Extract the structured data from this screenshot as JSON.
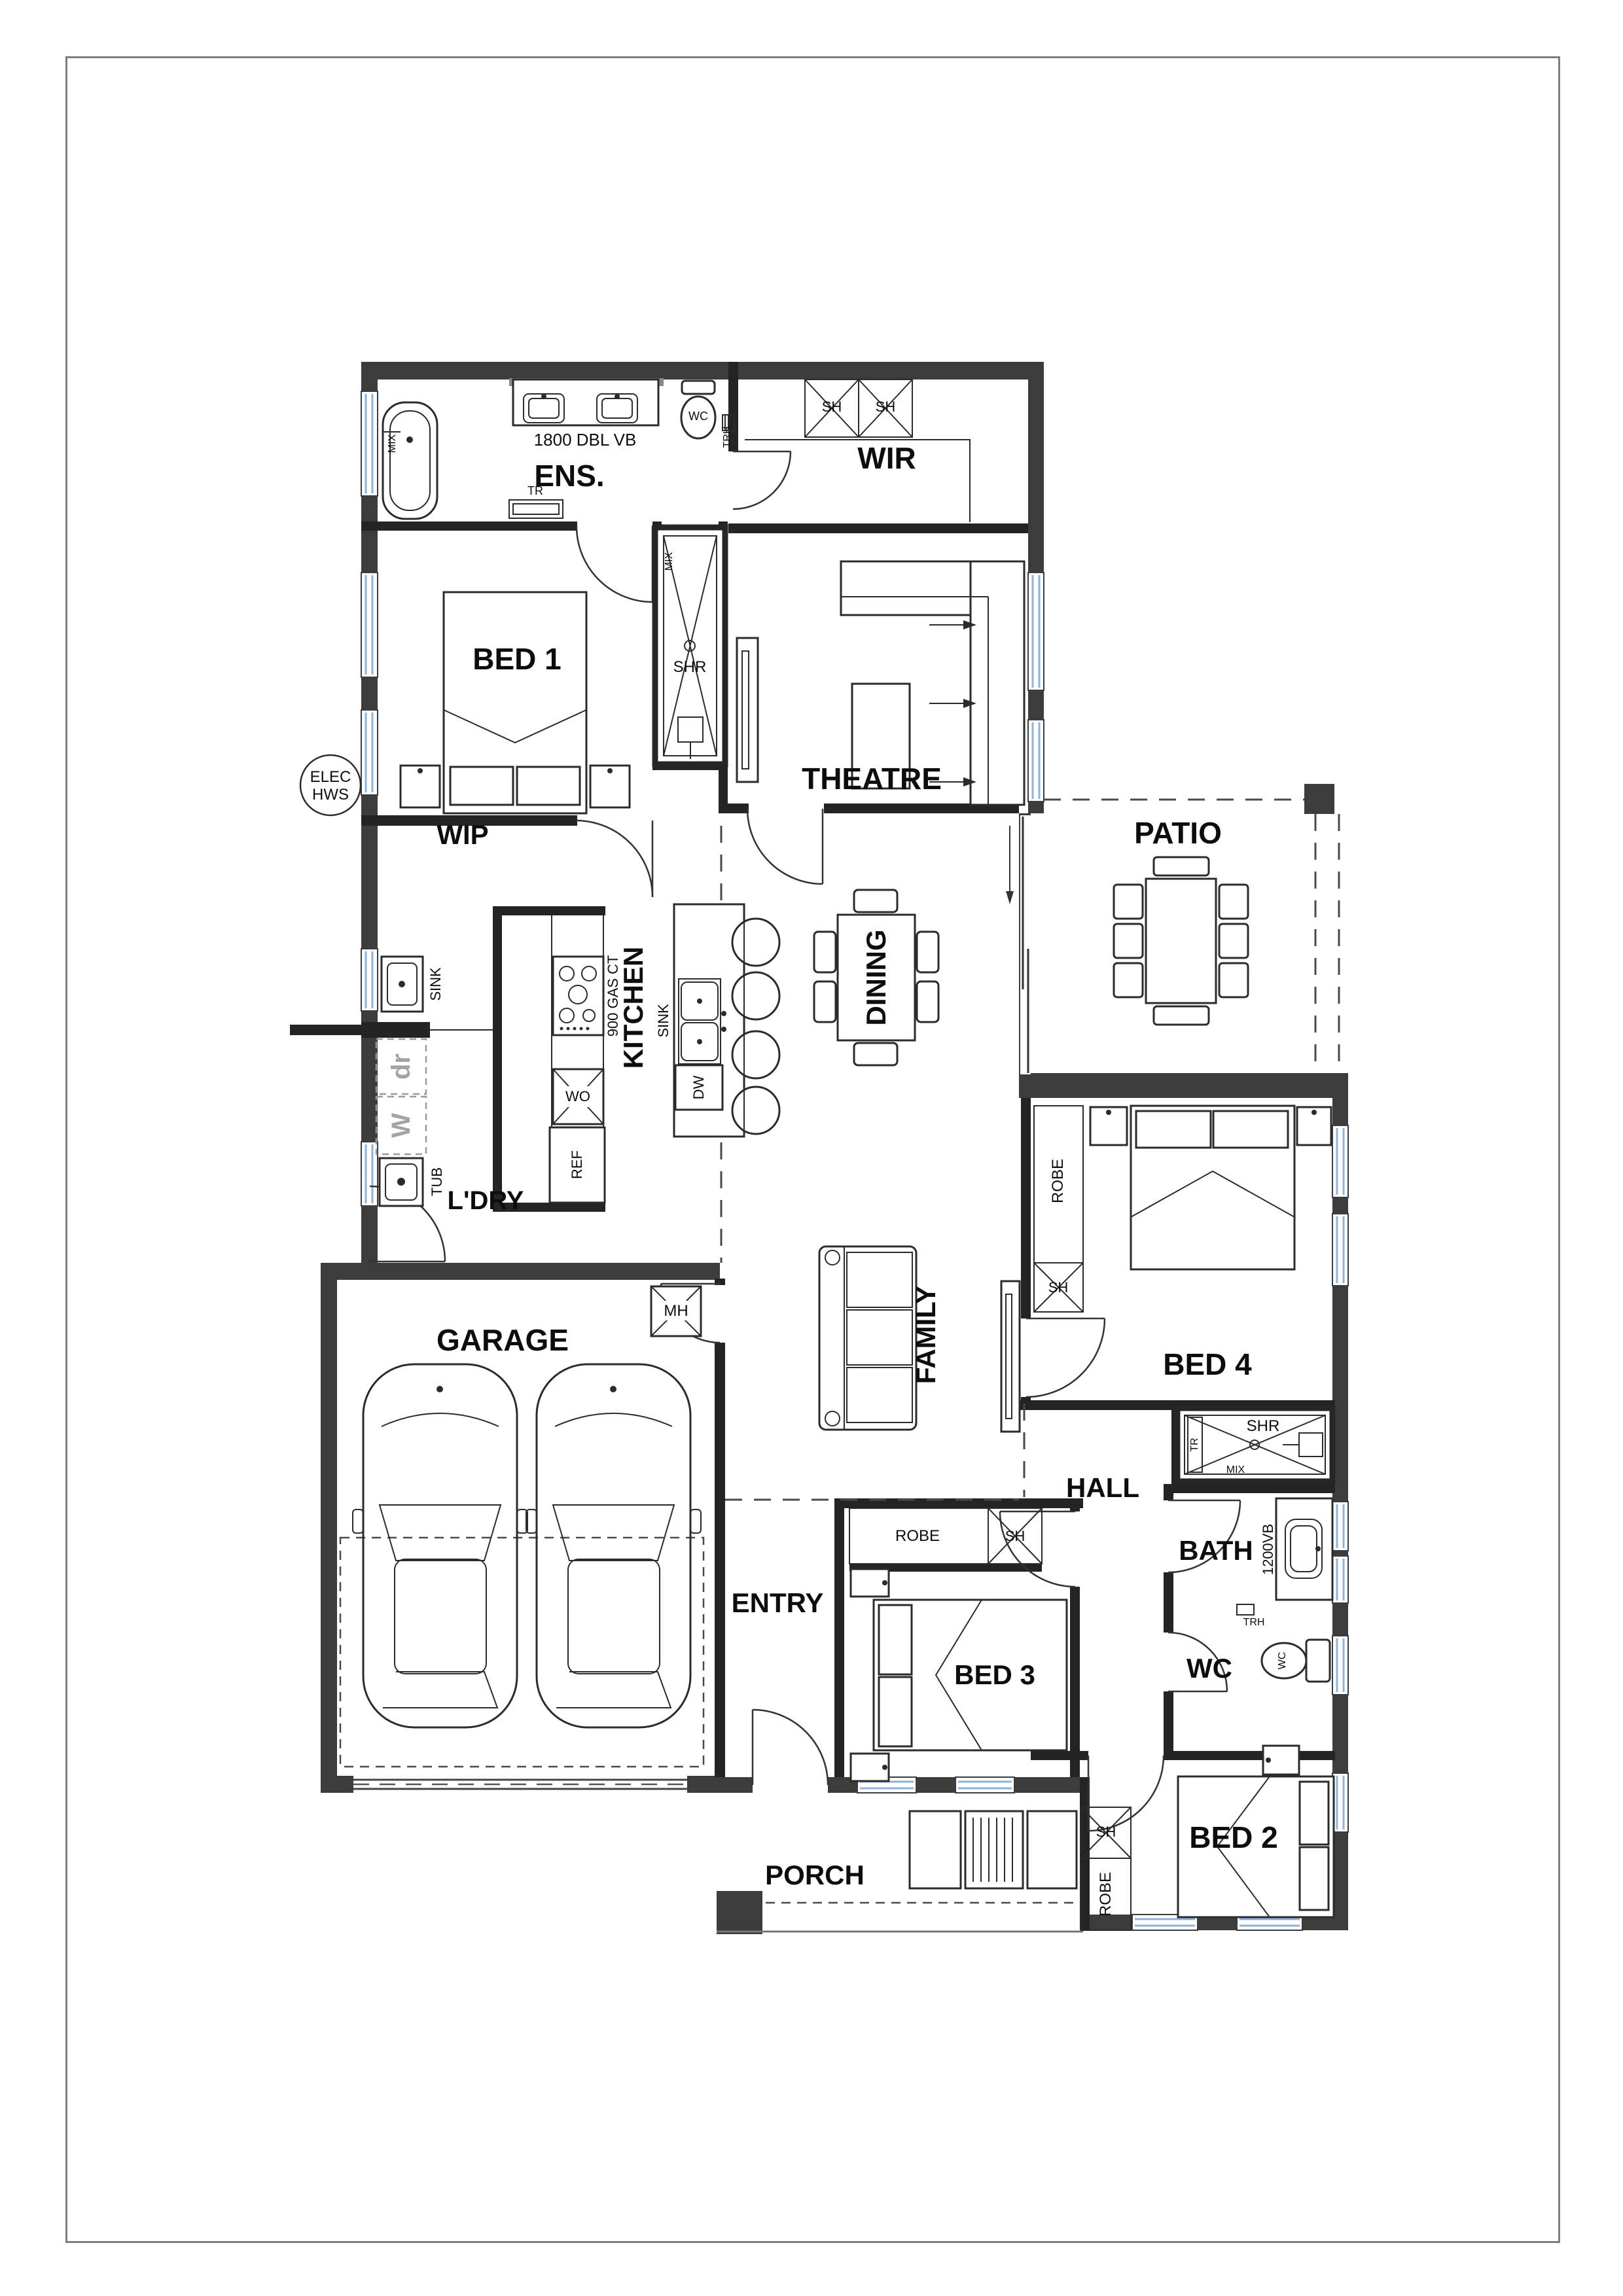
{
  "document": {
    "kind": "house-floor-plan"
  },
  "rooms": {
    "ens": "ENS.",
    "wir": "WIR",
    "bed1": "BED 1",
    "theatre": "THEATRE",
    "wip": "WIP",
    "ldry": "L'DRY",
    "kitchen": "KITCHEN",
    "dining": "DINING",
    "patio": "PATIO",
    "family": "FAMILY",
    "bed4": "BED 4",
    "garage": "GARAGE",
    "hall": "HALL",
    "entry": "ENTRY",
    "bed3": "BED 3",
    "bath": "BATH",
    "wc": "WC",
    "bed2": "BED 2",
    "porch": "PORCH"
  },
  "fixtures": {
    "sink": "SINK",
    "tub": "TUB",
    "fridge": "REF",
    "wall_oven": "WO",
    "dishwasher": "DW",
    "shower": "SHR",
    "shelf": "SH",
    "robe": "ROBE",
    "manhole": "MH",
    "towel_rail": "TR",
    "toilet_roll_holder": "TRH",
    "mixer": "MIX",
    "toilet_pan": "WC",
    "washer": "W",
    "dryer": "dr"
  },
  "annotations": {
    "ens_vanity": "1800 DBL VB",
    "cooktop": "900 GAS CT",
    "bath_vanity": "1200VB",
    "hot_water_line1": "ELEC",
    "hot_water_line2": "HWS"
  },
  "colors": {
    "wall_exterior": "#3c3c3c",
    "wall_interior": "#242424",
    "window_glass": "#8fb2d9",
    "dashed_line": "#4a4a4a",
    "muted_text": "#a3a3a3",
    "paper": "#ffffff"
  }
}
